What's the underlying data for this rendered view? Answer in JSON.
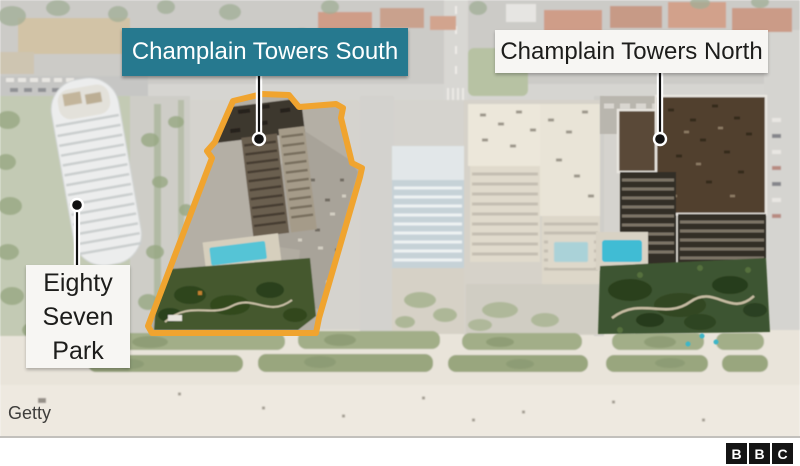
{
  "annotations": {
    "south": {
      "label": "Champlain Towers South"
    },
    "north": {
      "label": "Champlain Towers North"
    },
    "park": {
      "label": "Eighty Seven Park"
    },
    "credit": "Getty"
  },
  "logo": {
    "letters": [
      "B",
      "B",
      "C"
    ]
  },
  "colors": {
    "south_label_bg": "#26798F",
    "south_label_text": "#FFFFFF",
    "white_label_bg": "#F7F6F3",
    "label_text": "#1D1D1B",
    "highlight_outline": "#F0A42F",
    "leader_line": "#111111",
    "logo_square": "#141414"
  }
}
